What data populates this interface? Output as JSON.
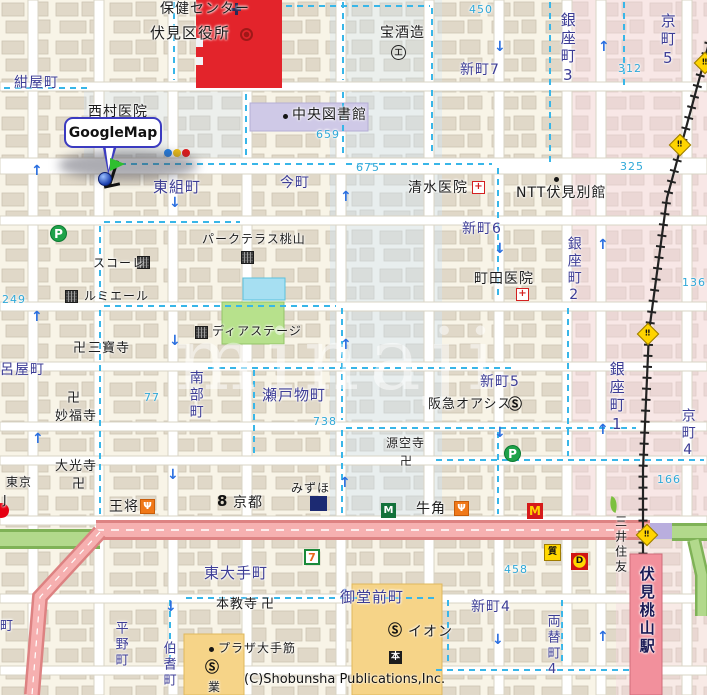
{
  "map": {
    "callout_label": "GoogleMap",
    "copyright": "(C)Shobunsha Publications,Inc.",
    "watermark": "minaji",
    "colors": {
      "town": "#3d3d96",
      "poi": "#1c1c1c",
      "num": "#2fa8d8",
      "sta": "#1a1a55",
      "accent_red": "#e3242b",
      "road_pink": "#f6b0b0",
      "road_green": "#b2d98c",
      "station_pink": "#f2909c",
      "boundary_cyan": "#38b6e8"
    },
    "labels": [
      {
        "t": "保健センター",
        "x": 160,
        "y": 2,
        "c": "poi",
        "s": 14,
        "n": "label-health-center"
      },
      {
        "t": "伏見区役所",
        "x": 150,
        "y": 26,
        "c": "poi",
        "s": 15,
        "n": "label-ward-office"
      },
      {
        "t": "紺屋町",
        "x": 14,
        "y": 76,
        "c": "town",
        "s": 14,
        "n": "label-konyacho"
      },
      {
        "t": "西村医院",
        "x": 88,
        "y": 105,
        "c": "poi",
        "s": 14,
        "n": "label-nishimura-clinic"
      },
      {
        "t": "中央図書館",
        "x": 292,
        "y": 108,
        "c": "poi",
        "s": 14,
        "n": "label-central-library"
      },
      {
        "t": "宝酒造",
        "x": 380,
        "y": 26,
        "c": "poi",
        "s": 14,
        "n": "label-takara-shuzo"
      },
      {
        "t": "新町7",
        "x": 460,
        "y": 63,
        "c": "town",
        "s": 14,
        "n": "label-shinmachi7"
      },
      {
        "t": "銀座町3",
        "x": 559,
        "y": 12,
        "c": "town",
        "s": 15,
        "v": true,
        "n": "label-ginzacho3"
      },
      {
        "t": "京町5",
        "x": 659,
        "y": 13,
        "c": "town",
        "s": 15,
        "v": true,
        "n": "label-kyomachi5"
      },
      {
        "t": "今町",
        "x": 280,
        "y": 176,
        "c": "town",
        "s": 14,
        "n": "label-imamachi"
      },
      {
        "t": "東組町",
        "x": 153,
        "y": 180,
        "c": "town",
        "s": 15,
        "n": "label-higashigumicho"
      },
      {
        "t": "清水医院",
        "x": 408,
        "y": 181,
        "c": "poi",
        "s": 14,
        "n": "label-shimizu-clinic"
      },
      {
        "t": "NTT伏見別館",
        "x": 516,
        "y": 186,
        "c": "poi",
        "s": 14,
        "n": "label-ntt-fushimi"
      },
      {
        "t": "新町6",
        "x": 462,
        "y": 222,
        "c": "town",
        "s": 14,
        "n": "label-shinmachi6"
      },
      {
        "t": "銀座町2",
        "x": 566,
        "y": 236,
        "c": "town",
        "s": 14,
        "v": true,
        "n": "label-ginzacho2"
      },
      {
        "t": "町田医院",
        "x": 474,
        "y": 272,
        "c": "poi",
        "s": 14,
        "n": "label-machida-clinic"
      },
      {
        "t": "スコーレ",
        "x": 93,
        "y": 257,
        "c": "poi",
        "s": 12,
        "n": "label-schole"
      },
      {
        "t": "ルミエール",
        "x": 84,
        "y": 290,
        "c": "poi",
        "s": 12,
        "n": "label-lumiere"
      },
      {
        "t": "パークテラス桃山",
        "x": 202,
        "y": 233,
        "c": "poi",
        "s": 12,
        "n": "label-park-terrace"
      },
      {
        "t": "卍",
        "x": 73,
        "y": 342,
        "c": "poi",
        "s": 13,
        "n": "label-manji-sanpoji"
      },
      {
        "t": "三寶寺",
        "x": 88,
        "y": 342,
        "c": "poi",
        "s": 13,
        "n": "label-sanpoji"
      },
      {
        "t": "呂屋町",
        "x": 0,
        "y": 363,
        "c": "town",
        "s": 14,
        "n": "label-royacho"
      },
      {
        "t": "卍",
        "x": 67,
        "y": 392,
        "c": "poi",
        "s": 13,
        "n": "label-manji-myofukuji"
      },
      {
        "t": "妙福寺",
        "x": 55,
        "y": 410,
        "c": "poi",
        "s": 13,
        "n": "label-myofukuji"
      },
      {
        "t": "ディアステージ",
        "x": 212,
        "y": 325,
        "c": "poi",
        "s": 12,
        "n": "label-dia-stage"
      },
      {
        "t": "南部町",
        "x": 188,
        "y": 370,
        "c": "town",
        "s": 14,
        "v": true,
        "n": "label-nanbucho"
      },
      {
        "t": "瀬戸物町",
        "x": 262,
        "y": 388,
        "c": "town",
        "s": 15,
        "n": "label-setomonocho"
      },
      {
        "t": "新町5",
        "x": 480,
        "y": 375,
        "c": "town",
        "s": 14,
        "n": "label-shinmachi5"
      },
      {
        "t": "阪急オアシス",
        "x": 428,
        "y": 398,
        "c": "poi",
        "s": 13,
        "n": "label-hankyu-oasis"
      },
      {
        "t": "銀座町1",
        "x": 608,
        "y": 361,
        "c": "town",
        "s": 15,
        "v": true,
        "n": "label-ginzacho1"
      },
      {
        "t": "京町4",
        "x": 680,
        "y": 408,
        "c": "town",
        "s": 14,
        "v": true,
        "n": "label-kyomachi4"
      },
      {
        "t": "源空寺",
        "x": 386,
        "y": 437,
        "c": "poi",
        "s": 12,
        "n": "label-genkuji"
      },
      {
        "t": "卍",
        "x": 400,
        "y": 455,
        "c": "poi",
        "s": 12,
        "n": "label-manji-genkuji"
      },
      {
        "t": "大光寺",
        "x": 55,
        "y": 460,
        "c": "poi",
        "s": 13,
        "n": "label-daikoji"
      },
      {
        "t": "卍",
        "x": 72,
        "y": 478,
        "c": "poi",
        "s": 13,
        "n": "label-manji-daikoji"
      },
      {
        "t": "東京",
        "x": 6,
        "y": 476,
        "c": "poi",
        "s": 12,
        "n": "label-tokyo-partial"
      },
      {
        "t": "J",
        "x": 3,
        "y": 494,
        "c": "poi",
        "s": 12,
        "n": "label-j-partial"
      },
      {
        "t": "王将",
        "x": 109,
        "y": 500,
        "c": "poi",
        "s": 14,
        "n": "label-ohsho"
      },
      {
        "t": "京都",
        "x": 233,
        "y": 496,
        "c": "poi",
        "s": 14,
        "n": "label-kyoto-bank"
      },
      {
        "t": "みずほ",
        "x": 291,
        "y": 482,
        "c": "poi",
        "s": 12,
        "n": "label-mizuho"
      },
      {
        "t": "牛角",
        "x": 416,
        "y": 502,
        "c": "poi",
        "s": 14,
        "n": "label-gyukaku"
      },
      {
        "t": "三井住友",
        "x": 614,
        "y": 515,
        "c": "poi",
        "s": 12,
        "v": true,
        "n": "label-mitsui-sumitomo"
      },
      {
        "t": "東大手町",
        "x": 204,
        "y": 566,
        "c": "town",
        "s": 15,
        "n": "label-higashiotecho"
      },
      {
        "t": "本教寺",
        "x": 216,
        "y": 598,
        "c": "poi",
        "s": 13,
        "n": "label-honkyoji"
      },
      {
        "t": "卍",
        "x": 261,
        "y": 598,
        "c": "poi",
        "s": 13,
        "n": "label-manji-honkyoji"
      },
      {
        "t": "御堂前町",
        "x": 340,
        "y": 590,
        "c": "town",
        "s": 15,
        "n": "label-midomaecho"
      },
      {
        "t": "新町4",
        "x": 471,
        "y": 600,
        "c": "town",
        "s": 14,
        "n": "label-shinmachi4"
      },
      {
        "t": "両替町4",
        "x": 545,
        "y": 614,
        "c": "town",
        "s": 13,
        "v": true,
        "n": "label-ryogaecho4"
      },
      {
        "t": "イオン",
        "x": 408,
        "y": 625,
        "c": "poi",
        "s": 14,
        "n": "label-aeon"
      },
      {
        "t": "プラザ大手筋",
        "x": 218,
        "y": 642,
        "c": "poi",
        "s": 12,
        "n": "label-plaza-otesuji"
      },
      {
        "t": "業",
        "x": 208,
        "y": 681,
        "c": "poi",
        "s": 12,
        "n": "label-gyo-partial"
      },
      {
        "t": "平野町",
        "x": 113,
        "y": 621,
        "c": "town",
        "s": 13,
        "v": true,
        "n": "label-hiranocho"
      },
      {
        "t": "伯耆町",
        "x": 161,
        "y": 641,
        "c": "town",
        "s": 13,
        "v": true,
        "n": "label-hokicho"
      },
      {
        "t": "町",
        "x": 0,
        "y": 620,
        "c": "town",
        "s": 13,
        "n": "label-cho-partial"
      },
      {
        "t": "伏見桃山駅",
        "x": 638,
        "y": 566,
        "c": "sta",
        "s": 15,
        "v": true,
        "b": true,
        "n": "label-fushimi-momoyama-station"
      },
      {
        "t": "450",
        "x": 469,
        "y": 4,
        "c": "num",
        "s": 11,
        "n": "block-number"
      },
      {
        "t": "659",
        "x": 316,
        "y": 129,
        "c": "num",
        "s": 11,
        "n": "block-number"
      },
      {
        "t": "675",
        "x": 356,
        "y": 162,
        "c": "num",
        "s": 11,
        "n": "block-number"
      },
      {
        "t": "312",
        "x": 618,
        "y": 63,
        "c": "num",
        "s": 11,
        "n": "block-number"
      },
      {
        "t": "325",
        "x": 620,
        "y": 161,
        "c": "num",
        "s": 11,
        "n": "block-number"
      },
      {
        "t": "136",
        "x": 682,
        "y": 277,
        "c": "num",
        "s": 11,
        "n": "block-number"
      },
      {
        "t": "249",
        "x": 2,
        "y": 294,
        "c": "num",
        "s": 11,
        "n": "block-number"
      },
      {
        "t": "77",
        "x": 144,
        "y": 392,
        "c": "num",
        "s": 11,
        "n": "block-number"
      },
      {
        "t": "738",
        "x": 313,
        "y": 416,
        "c": "num",
        "s": 11,
        "n": "block-number"
      },
      {
        "t": "458",
        "x": 504,
        "y": 564,
        "c": "num",
        "s": 11,
        "n": "block-number"
      },
      {
        "t": "166",
        "x": 657,
        "y": 474,
        "c": "num",
        "s": 11,
        "n": "block-number"
      }
    ],
    "icons": [
      {
        "k": "traffic",
        "x": 164,
        "y": 149,
        "n": "traffic-light-icon"
      },
      {
        "k": "health",
        "x": 231,
        "y": 3,
        "n": "health-center-symbol"
      },
      {
        "k": "gov",
        "x": 240,
        "y": 28,
        "n": "ward-office-symbol"
      },
      {
        "k": "dot",
        "x": 283,
        "y": 114,
        "n": "library-dot-icon"
      },
      {
        "k": "factory",
        "x": 391,
        "y": 45,
        "g": "工",
        "n": "factory-symbol-takara"
      },
      {
        "k": "hospital",
        "x": 472,
        "y": 181,
        "g": "+",
        "n": "hospital-icon-shimizu"
      },
      {
        "k": "dot",
        "x": 554,
        "y": 177,
        "n": "ntt-dot-icon"
      },
      {
        "k": "hospital",
        "x": 516,
        "y": 288,
        "g": "+",
        "n": "hospital-icon-machida"
      },
      {
        "k": "parking",
        "x": 50,
        "y": 225,
        "g": "P",
        "n": "parking-icon"
      },
      {
        "k": "parking",
        "x": 504,
        "y": 445,
        "g": "P",
        "n": "parking-icon"
      },
      {
        "k": "bldg",
        "x": 137,
        "y": 256,
        "n": "building-icon-schole"
      },
      {
        "k": "bldg",
        "x": 65,
        "y": 290,
        "n": "building-icon-lumiere"
      },
      {
        "k": "bldg",
        "x": 241,
        "y": 251,
        "n": "building-icon-park-terrace"
      },
      {
        "k": "bldg",
        "x": 195,
        "y": 326,
        "n": "building-icon-dia-stage"
      },
      {
        "k": "scircle",
        "x": 508,
        "y": 398,
        "g": "Ⓢ",
        "n": "supermarket-icon-hankyu"
      },
      {
        "k": "scircle",
        "x": 388,
        "y": 624,
        "g": "Ⓢ",
        "n": "supermarket-icon-aeon"
      },
      {
        "k": "scircle",
        "x": 205,
        "y": 661,
        "g": "Ⓢ",
        "n": "supermarket-icon-plaza"
      },
      {
        "k": "dot",
        "x": 209,
        "y": 647,
        "n": "plaza-dot-icon"
      },
      {
        "k": "book",
        "x": 389,
        "y": 651,
        "g": "本",
        "n": "bookstore-icon"
      },
      {
        "k": "seven",
        "x": 304,
        "y": 549,
        "g": "7",
        "n": "seven-eleven-icon"
      },
      {
        "k": "mos",
        "x": 381,
        "y": 503,
        "g": "M",
        "n": "mos-burger-icon"
      },
      {
        "k": "mcd",
        "x": 527,
        "y": 503,
        "g": "M",
        "n": "mcdonalds-icon"
      },
      {
        "k": "resto",
        "x": 140,
        "y": 499,
        "g": "Ψ",
        "n": "restaurant-icon-ohsho"
      },
      {
        "k": "resto",
        "x": 454,
        "y": 501,
        "g": "Ψ",
        "n": "restaurant-icon-gyukaku"
      },
      {
        "k": "bank8",
        "x": 217,
        "y": 494,
        "g": "8",
        "n": "kyoto-bank-symbol"
      },
      {
        "k": "mizuho",
        "x": 310,
        "y": 496,
        "n": "mizuho-logo-block"
      },
      {
        "k": "leaf",
        "x": 609,
        "y": 497,
        "n": "smbc-leaf-icon"
      },
      {
        "k": "mufg",
        "x": -6,
        "y": 503,
        "n": "mufg-logo-partial"
      },
      {
        "k": "pawn",
        "x": 544,
        "y": 544,
        "g": "質",
        "n": "yellow-shop-icon"
      },
      {
        "k": "dshop",
        "x": 571,
        "y": 553,
        "g": "D",
        "n": "red-shop-icon"
      },
      {
        "k": "crossing",
        "x": 672,
        "y": 137,
        "g": "‼",
        "n": "railroad-crossing-icon"
      },
      {
        "k": "crossing",
        "x": 640,
        "y": 326,
        "g": "‼",
        "n": "railroad-crossing-icon"
      },
      {
        "k": "crossing",
        "x": 639,
        "y": 527,
        "g": "‼",
        "n": "railroad-crossing-icon"
      },
      {
        "k": "crossing",
        "x": 697,
        "y": 55,
        "g": "‼",
        "n": "railroad-crossing-icon"
      }
    ],
    "arrows": [
      {
        "d": "u",
        "x": 31,
        "y": 164
      },
      {
        "d": "u",
        "x": 31,
        "y": 310
      },
      {
        "d": "u",
        "x": 32,
        "y": 432
      },
      {
        "d": "u",
        "x": 340,
        "y": 190
      },
      {
        "d": "u",
        "x": 340,
        "y": 338
      },
      {
        "d": "u",
        "x": 339,
        "y": 476
      },
      {
        "d": "u",
        "x": 339,
        "y": 588
      },
      {
        "d": "u",
        "x": 598,
        "y": 40
      },
      {
        "d": "u",
        "x": 597,
        "y": 238
      },
      {
        "d": "u",
        "x": 597,
        "y": 423
      },
      {
        "d": "u",
        "x": 597,
        "y": 630
      },
      {
        "d": "d",
        "x": 494,
        "y": 40
      },
      {
        "d": "d",
        "x": 494,
        "y": 242
      },
      {
        "d": "d",
        "x": 494,
        "y": 426
      },
      {
        "d": "d",
        "x": 492,
        "y": 633
      },
      {
        "d": "d",
        "x": 169,
        "y": 196
      },
      {
        "d": "d",
        "x": 169,
        "y": 334
      },
      {
        "d": "d",
        "x": 167,
        "y": 468
      },
      {
        "d": "d",
        "x": 165,
        "y": 600
      }
    ]
  }
}
